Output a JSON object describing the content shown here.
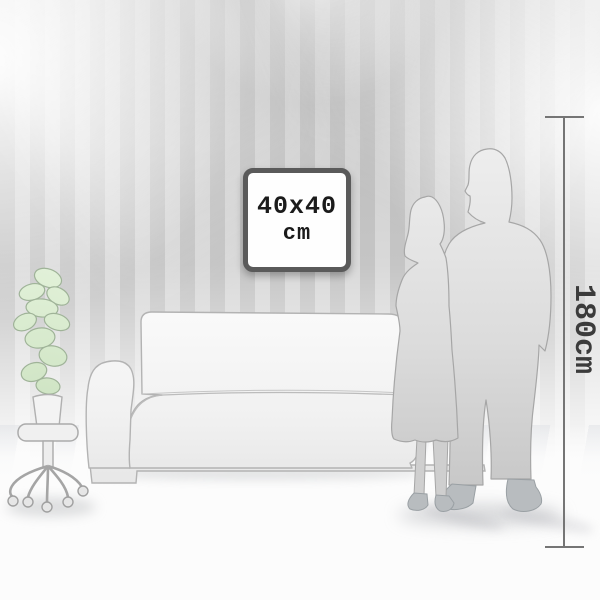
{
  "frame": {
    "size": "40x40",
    "unit": "cm"
  },
  "measurement": {
    "height": "180cm"
  },
  "scene": {
    "elements": [
      "striped-wallpaper-wall",
      "ceiling-spotlight-beams",
      "picture-frame",
      "height-measure-ruler",
      "couple-silhouette",
      "sofa-silhouette",
      "potted-plant-on-stool",
      "floor-with-light-streaks"
    ]
  },
  "colors": {
    "frame_border": "#5a5a5a",
    "frame_text": "#1b1b1b",
    "measure_line": "#757575",
    "measure_text": "#3b3b3b",
    "wall_stripe_dark": "#c5c5c5",
    "wall_stripe_light": "#d9d9d9",
    "silhouette_top": "#ededed",
    "silhouette_bottom": "#c6c6c6",
    "silhouette_outline": "#a6a6a6",
    "feet_gray": "#b6babd",
    "plant_green": "#dcedd3",
    "plant_outline": "#9fb398",
    "sofa_fill": "#f6f6f6",
    "sofa_outline": "#b3b3b3",
    "floor_white": "#fcfcfc"
  }
}
